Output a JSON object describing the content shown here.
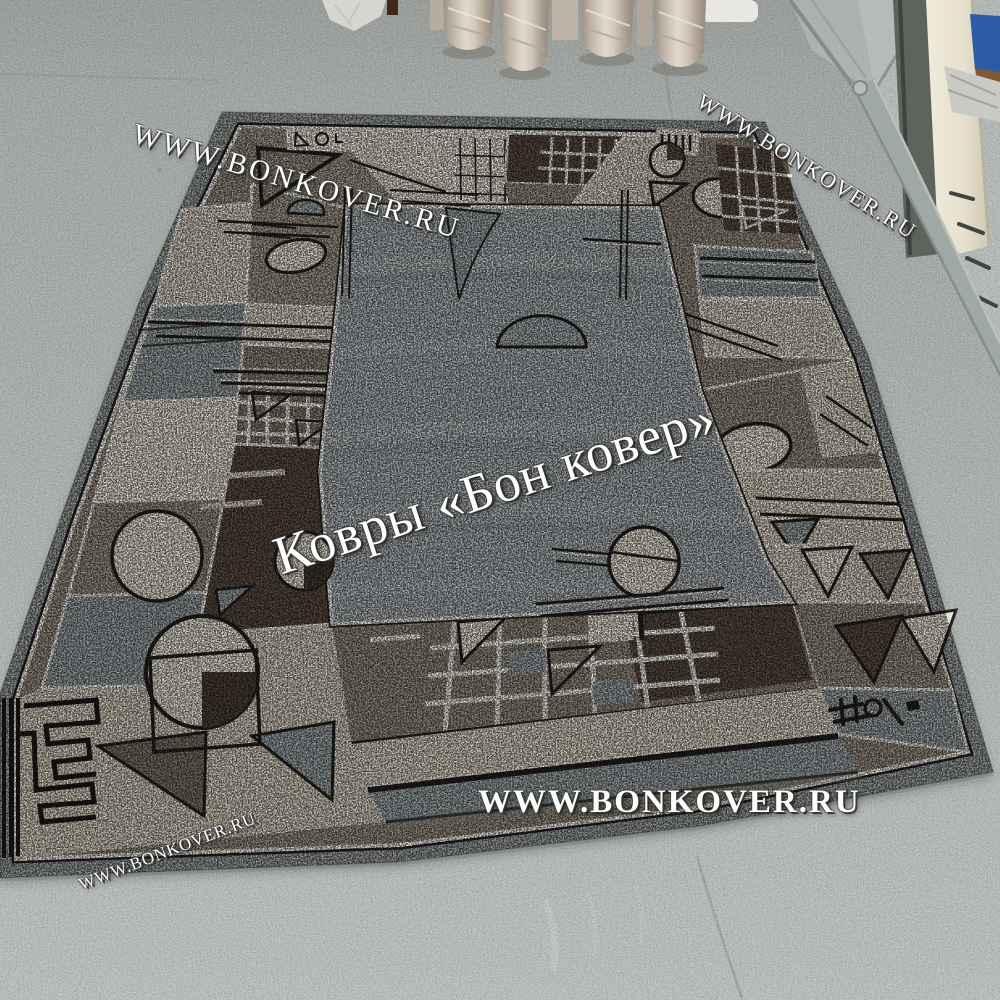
{
  "watermarks": {
    "top_left": "WWW.BONKOVER.RU",
    "top_right": "WWW.BONKOVER.RU",
    "center": "Ковры «Бон ковер»",
    "bottom_center": "WWW.BONKOVER.RU",
    "bottom_left": "WWW.BONKOVER.RU"
  },
  "scene": {
    "subject": "grey carpet with geometric cream-brown border on painted concrete floor",
    "background": "plastic-wrapped carpet rolls and shop doorway"
  },
  "colors": {
    "floor": "#b6bbb8",
    "floor_light": "#c6cbc8",
    "field": "#adb3b6",
    "selvedge": "#9aa09e",
    "cream": "#ddd5c4",
    "cream_bright": "#e9e3d4",
    "taupe": "#9a9183",
    "taupe_dark": "#8d8478",
    "brown": "#5c4e42",
    "grey_blue": "#9ca4a6",
    "line_white": "#f2efe7",
    "pattern_black": "#26231f",
    "roll_wrap": "#cdc3b7",
    "door_frame": "#e9e4d2",
    "door_blue": "#2d5ba6",
    "metal": "#9fa8a5"
  }
}
